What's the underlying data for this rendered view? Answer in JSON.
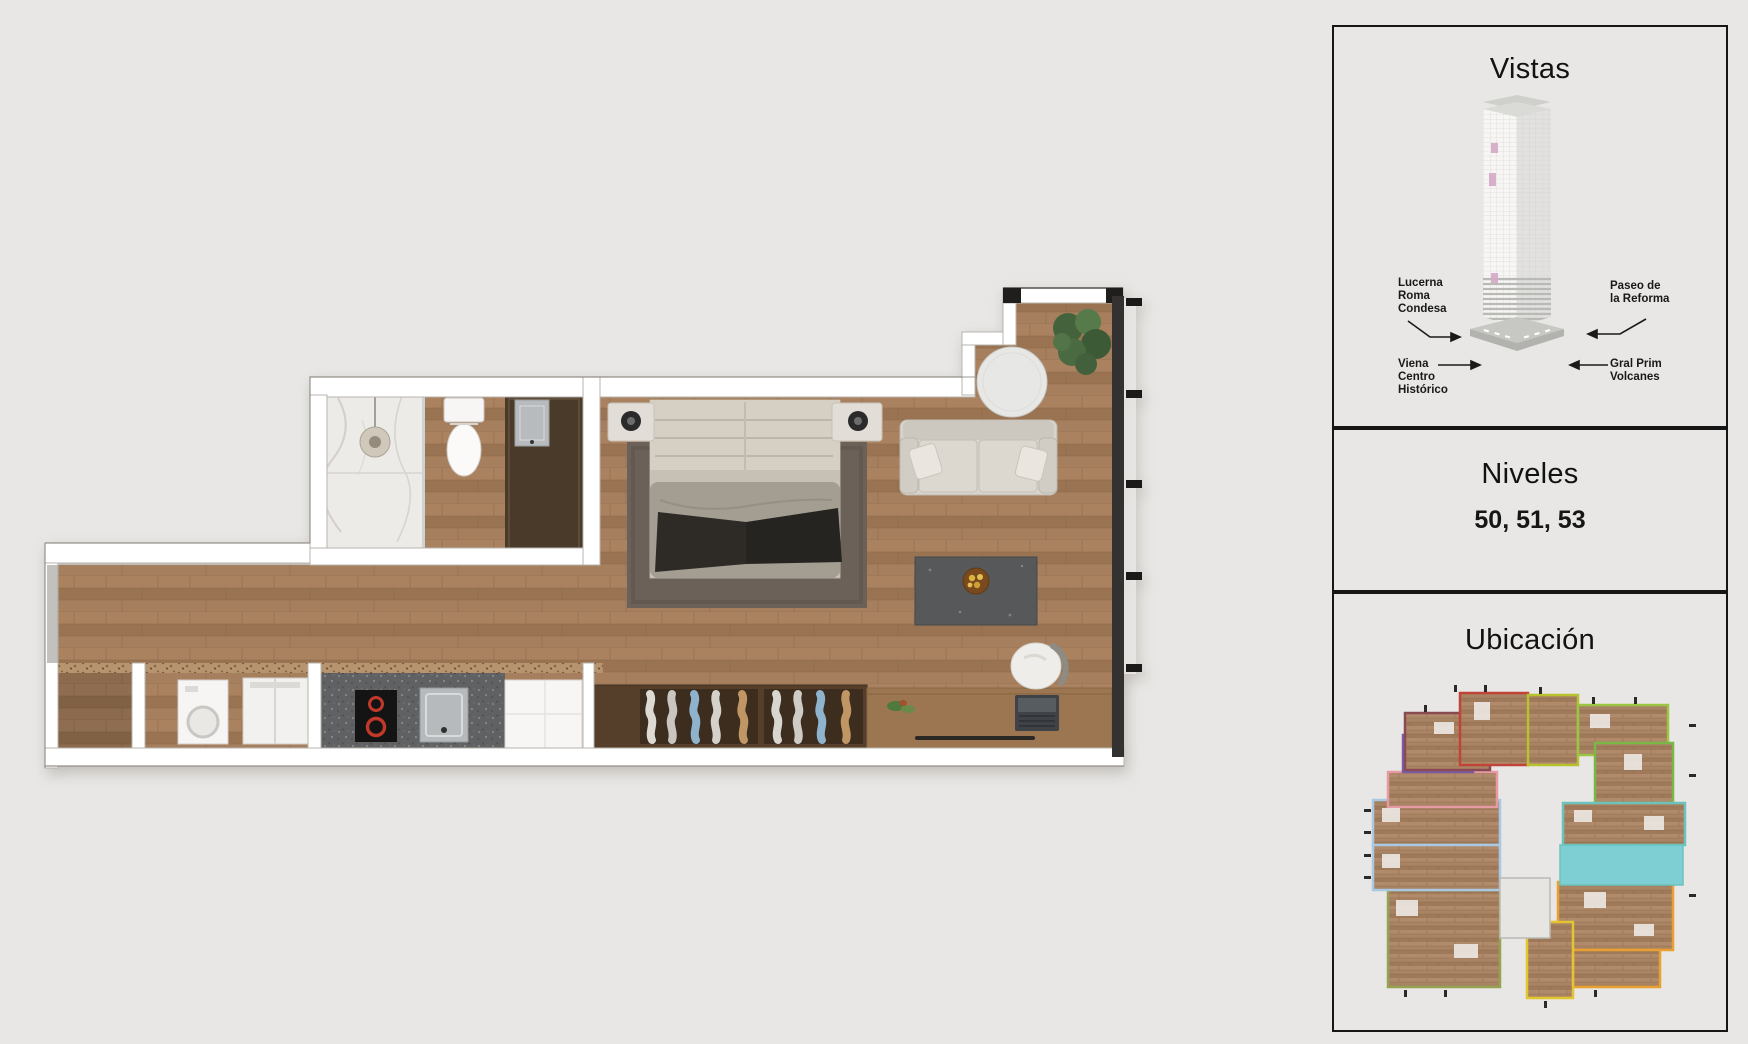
{
  "page": {
    "background": "#e8e7e5",
    "accent_highlight": "#7ecfd4"
  },
  "sidebar": {
    "vistas": {
      "title": "Vistas",
      "labels": [
        {
          "id": "lucerna",
          "lines": [
            "Lucerna",
            "Roma",
            "Condesa"
          ]
        },
        {
          "id": "paseo",
          "lines": [
            "Paseo de",
            "la Reforma"
          ]
        },
        {
          "id": "viena",
          "lines": [
            "Viena",
            "Centro",
            "Histórico"
          ]
        },
        {
          "id": "gral",
          "lines": [
            "Gral Prim",
            "Volcanes"
          ]
        }
      ],
      "tower_window_color": "#d5a9c5"
    },
    "niveles": {
      "title": "Niveles",
      "values": "50, 51, 53"
    },
    "ubicacion": {
      "title": "Ubicación",
      "highlighted_unit_color": "#7ecfd4",
      "unit_outline_colors": [
        "#8a4a52",
        "#c04438",
        "#b8c22e",
        "#9dc544",
        "#7ab648",
        "#6cc3bd",
        "#7a5ba6",
        "#e59aa4",
        "#a9c9e2",
        "#95a452",
        "#e3c52f",
        "#e8a030"
      ]
    }
  },
  "floorplan": {
    "floor_wood": "#a37c59",
    "wall": "#ffffff",
    "marble": "#edebe7",
    "granite": "#5f6162",
    "closet_wood": "#553f2a",
    "rug": "#6b6159",
    "balcony_wall": "#343230",
    "cooktop_burner": "#c0392b"
  }
}
